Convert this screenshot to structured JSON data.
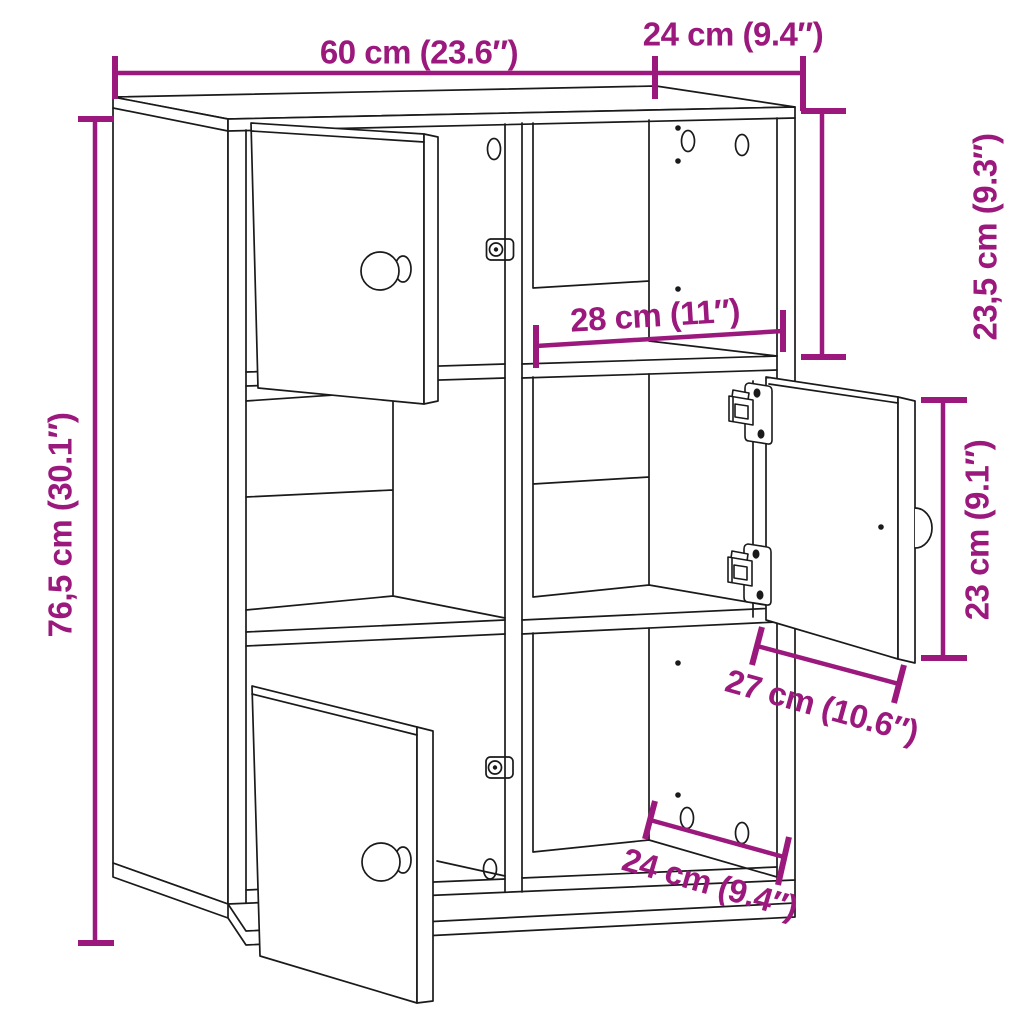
{
  "diagram": {
    "title": "Bookcase dimension line drawing",
    "type": "product-dimension-diagram",
    "colors": {
      "dimension": "#9B197D",
      "line": "#1A1A1A",
      "background": "#FFFFFF"
    },
    "product": {
      "overall_width_cm": 60,
      "overall_depth_cm": 24,
      "overall_height_cm": 76.5
    },
    "dimensions": {
      "width_top": {
        "label": "60 cm (23.6″)",
        "cm": 60,
        "inches": 23.6
      },
      "depth_top": {
        "label": "24 cm (9.4″)",
        "cm": 24,
        "inches": 9.4
      },
      "height_left": {
        "label": "76,5 cm (30.1″)",
        "cm": 76.5,
        "inches": 30.1
      },
      "top_compartment_height": {
        "label": "23,5 cm (9.3″)",
        "cm": 23.5,
        "inches": 9.3
      },
      "inner_width": {
        "label": "28 cm (11″)",
        "cm": 28,
        "inches": 11
      },
      "door_height": {
        "label": "23 cm (9.1″)",
        "cm": 23,
        "inches": 9.1
      },
      "door_width": {
        "label": "27 cm (10.6″)",
        "cm": 27,
        "inches": 10.6
      },
      "depth_bottom": {
        "label": "24 cm (9.4″)",
        "cm": 24,
        "inches": 9.4
      }
    }
  }
}
